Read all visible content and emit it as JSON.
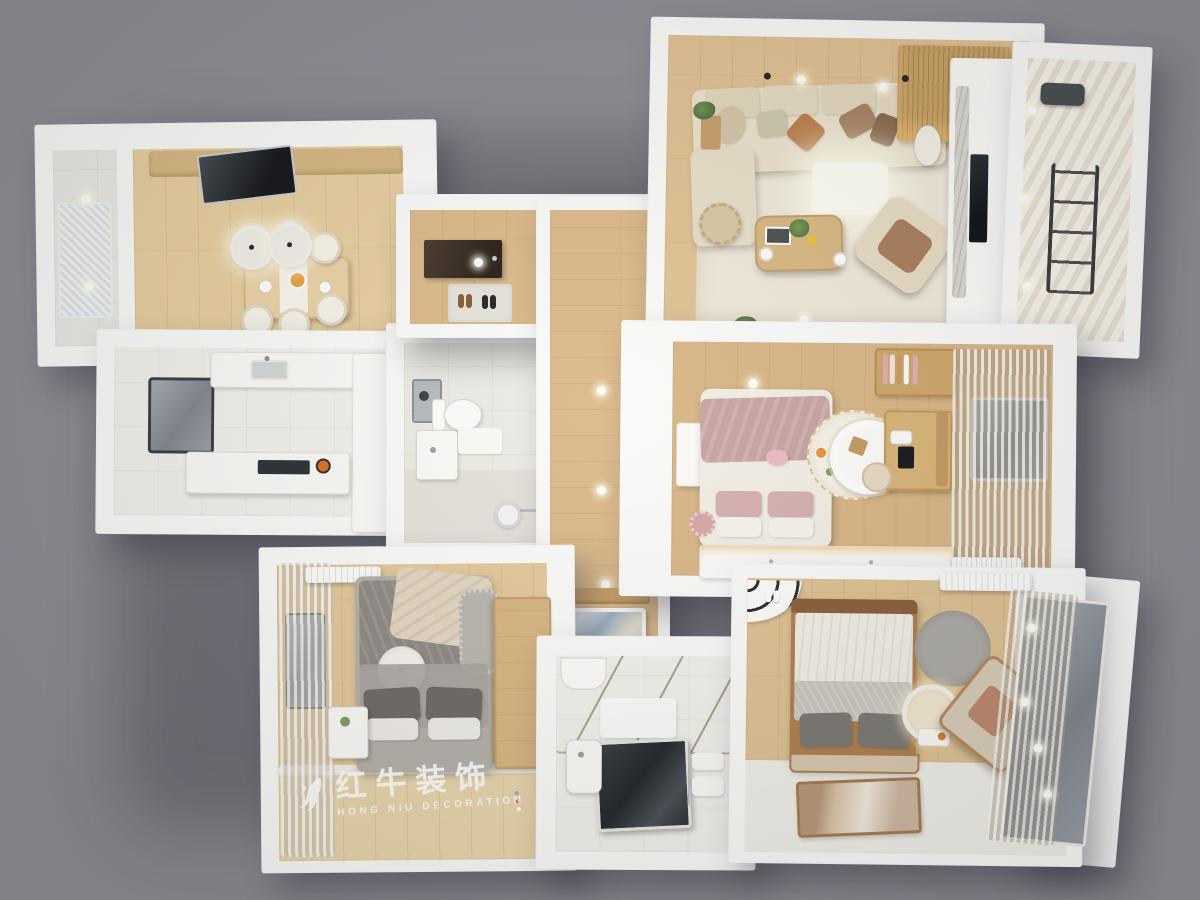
{
  "scene": {
    "type": "3d-rendered-floorplan-top-view",
    "style": "wood-and-white japandi apartment render on gray backdrop",
    "rooms": [
      {
        "id": "balcony-left",
        "contents": [
          "frosted-panel",
          "downlights"
        ]
      },
      {
        "id": "dining-room",
        "contents": [
          "dining-table",
          "six-chairs",
          "two-pendant-lamps",
          "wall-counter",
          "dark-glass-panel"
        ]
      },
      {
        "id": "kitchen",
        "contents": [
          "l-counter",
          "sink",
          "cooktop",
          "pot",
          "window",
          "tall-cabinet"
        ]
      },
      {
        "id": "bathroom-main",
        "contents": [
          "toilet",
          "vanity",
          "washer",
          "shower-head",
          "bath-mat"
        ]
      },
      {
        "id": "entry-hall",
        "contents": [
          "front-door",
          "doormat",
          "shoes",
          "downlights"
        ]
      },
      {
        "id": "corridor",
        "contents": [
          "downlights",
          "wood-accent-panel",
          "framed-art"
        ]
      },
      {
        "id": "living-room",
        "contents": [
          "sectional-sofa",
          "throw-pillows",
          "glowing-light-panel",
          "coffee-table",
          "plant",
          "coffee-cups",
          "armchair",
          "area-rug",
          "jute-pouf",
          "side-table",
          "tv",
          "marble-strip",
          "wood-slat-wall",
          "ceiling-spots"
        ]
      },
      {
        "id": "balcony-top-right",
        "contents": [
          "striped-tile-floor",
          "drying-rack",
          "treadmill"
        ]
      },
      {
        "id": "master-bedroom",
        "contents": [
          "double-bed",
          "pink-blanket",
          "pillows",
          "plush-toy",
          "round-rug",
          "fluffy-chair",
          "wood-stool",
          "desk",
          "shelf",
          "bookshelf",
          "dresser",
          "window",
          "curtains",
          "lit-wardrobe",
          "radiator"
        ]
      },
      {
        "id": "bedroom-left",
        "contents": [
          "bed",
          "round-pillow",
          "beige-blanket",
          "fluffy-throw",
          "nightstand",
          "wardrobe",
          "window",
          "curtains",
          "ac-unit",
          "wood-platform",
          "hanging-beads"
        ]
      },
      {
        "id": "bathroom-second",
        "contents": [
          "glass-shower-partition",
          "dark-glass-floor",
          "pedestal-sink",
          "towel-rack",
          "toilet"
        ]
      },
      {
        "id": "bedroom-right",
        "contents": [
          "wood-frame-bed",
          "gray-pillows",
          "arch-stripe-mat",
          "slippers",
          "round-gray-rug",
          "vanity-mirror",
          "lounge-chair",
          "runner-art-rug",
          "ac-unit",
          "window-wall",
          "sheer-curtains",
          "downlights"
        ]
      }
    ]
  },
  "watermark": {
    "brand_cn": "红牛装饰",
    "brand_en": "HONG NIU DECORATION",
    "registered_mark": "®",
    "icon": "bull-antler-icon"
  },
  "palette": {
    "background": "#8e8e96",
    "wall": "#fbfbfa",
    "wood_dining": "#e8cf9f",
    "wood_hall": "#dcba8a",
    "wood_living": "#e2c294",
    "wood_master": "#d9b687",
    "wood_bedleft": "#e4c89a",
    "wood_bedright": "#dfc293",
    "wood_light": "#ead6ad",
    "tile": "#f3f1ec",
    "tile_bath": "#edebe4",
    "rug": "#f0e9da",
    "glass": "#868c93",
    "accent_wood": "#c9a267",
    "curtain_taupe": "#c4b8a9",
    "bed_pink": "#c9a4a4",
    "bed_gray": "#8f8a84",
    "glow": "#fffef5"
  }
}
